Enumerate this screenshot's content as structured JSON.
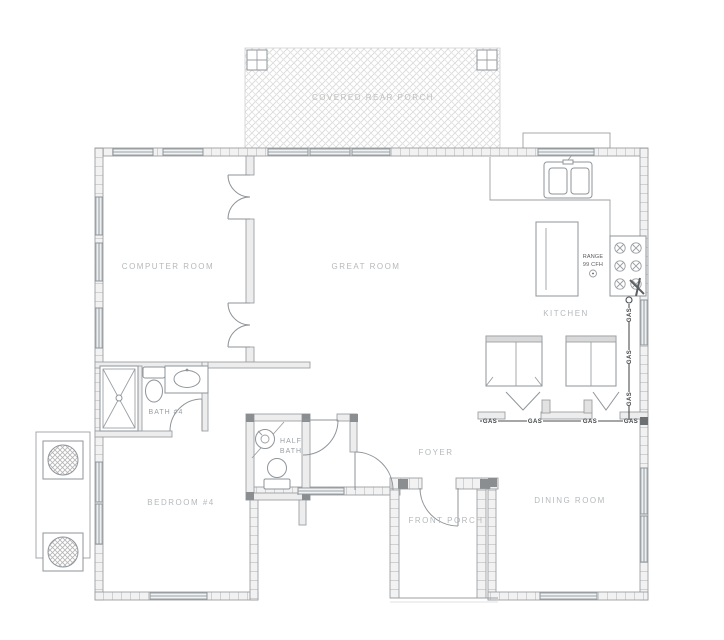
{
  "title": "House Floor Plan",
  "labels": {
    "covered_rear_porch": "COVERED REAR PORCH",
    "computer_room": "COMPUTER ROOM",
    "great_room": "GREAT ROOM",
    "kitchen": "KITCHEN",
    "bath4": "BATH #4",
    "half_bath_line1": "HALF",
    "half_bath_line2": "BATH",
    "bedroom4": "BEDROOM #4",
    "foyer": "FOYER",
    "front_porch": "FRONT PORCH",
    "dining_room": "DINING ROOM"
  },
  "annotations": {
    "range_line1": "RANGE",
    "range_line2": "99 CFH",
    "gas_label": "GAS"
  },
  "colors": {
    "line": "#9b9fa3",
    "wall_fill": "#f2f2f2",
    "label_text": "#b5b9bc",
    "gas_text": "#3f4448",
    "porch_hatch": "#dcdcdc"
  }
}
